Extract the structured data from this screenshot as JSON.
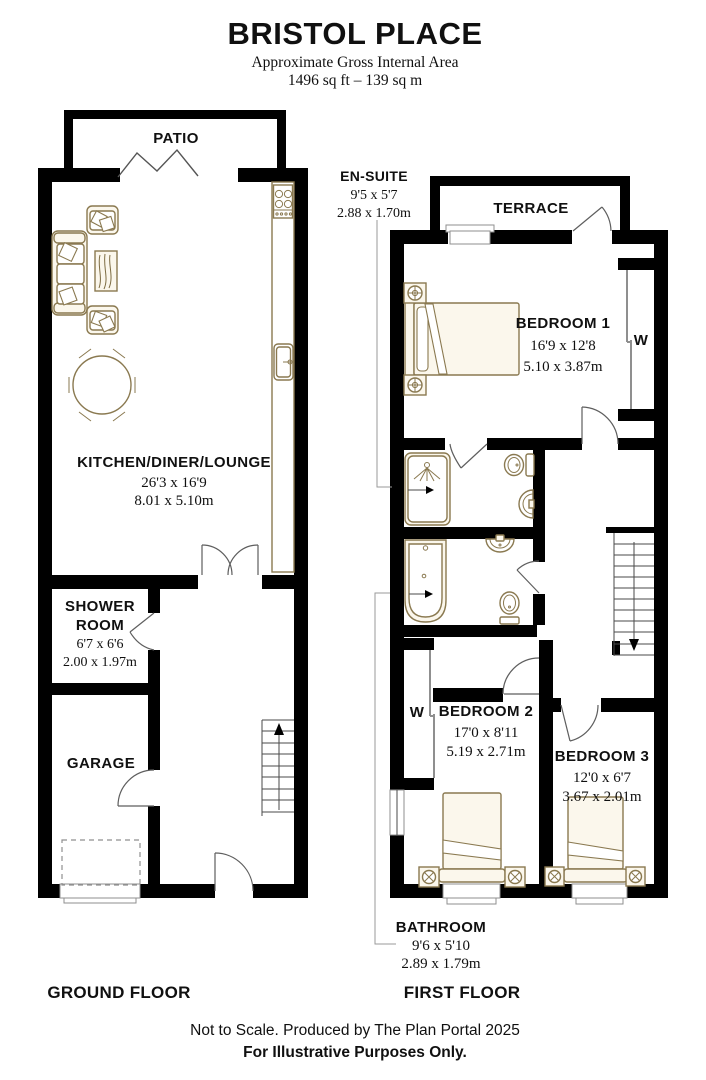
{
  "header": {
    "title": "BRISTOL PLACE",
    "subtitle": "Approximate Gross Internal Area",
    "area": "1496 sq ft – 139 sq m"
  },
  "ground_floor": {
    "label": "GROUND FLOOR",
    "patio": "PATIO",
    "kitchen_diner_lounge": {
      "name": "KITCHEN/DINER/LOUNGE",
      "size_ft": "26'3 x 16'9",
      "size_m": "8.01 x 5.10m"
    },
    "shower_room": {
      "name_line1": "SHOWER",
      "name_line2": "ROOM",
      "size_ft": "6'7 x 6'6",
      "size_m": "2.00 x 1.97m"
    },
    "garage": "GARAGE"
  },
  "first_floor": {
    "label": "FIRST FLOOR",
    "terrace": "TERRACE",
    "en_suite": {
      "name": "EN-SUITE",
      "size_ft": "9'5 x 5'7",
      "size_m": "2.88 x 1.70m"
    },
    "bedroom_1": {
      "name": "BEDROOM 1",
      "size_ft": "16'9 x 12'8",
      "size_m": "5.10 x 3.87m",
      "wardrobe": "W"
    },
    "bedroom_2": {
      "name": "BEDROOM 2",
      "size_ft": "17'0 x 8'11",
      "size_m": "5.19 x 2.71m",
      "wardrobe": "W"
    },
    "bedroom_3": {
      "name": "BEDROOM 3",
      "size_ft": "12'0 x 6'7",
      "size_m": "3.67 x 2.01m"
    },
    "bathroom": {
      "name": "BATHROOM",
      "size_ft": "9'6 x 5'10",
      "size_m": "2.89 x 1.79m"
    }
  },
  "footer": {
    "line1": "Not to Scale. Produced by The Plan Portal 2025",
    "line2": "For Illustrative Purposes Only."
  },
  "colors": {
    "wall": "#000000",
    "furniture_line": "#8a7950",
    "furniture_fill": "#fbf7ec",
    "door_line": "#5e5e5e"
  }
}
